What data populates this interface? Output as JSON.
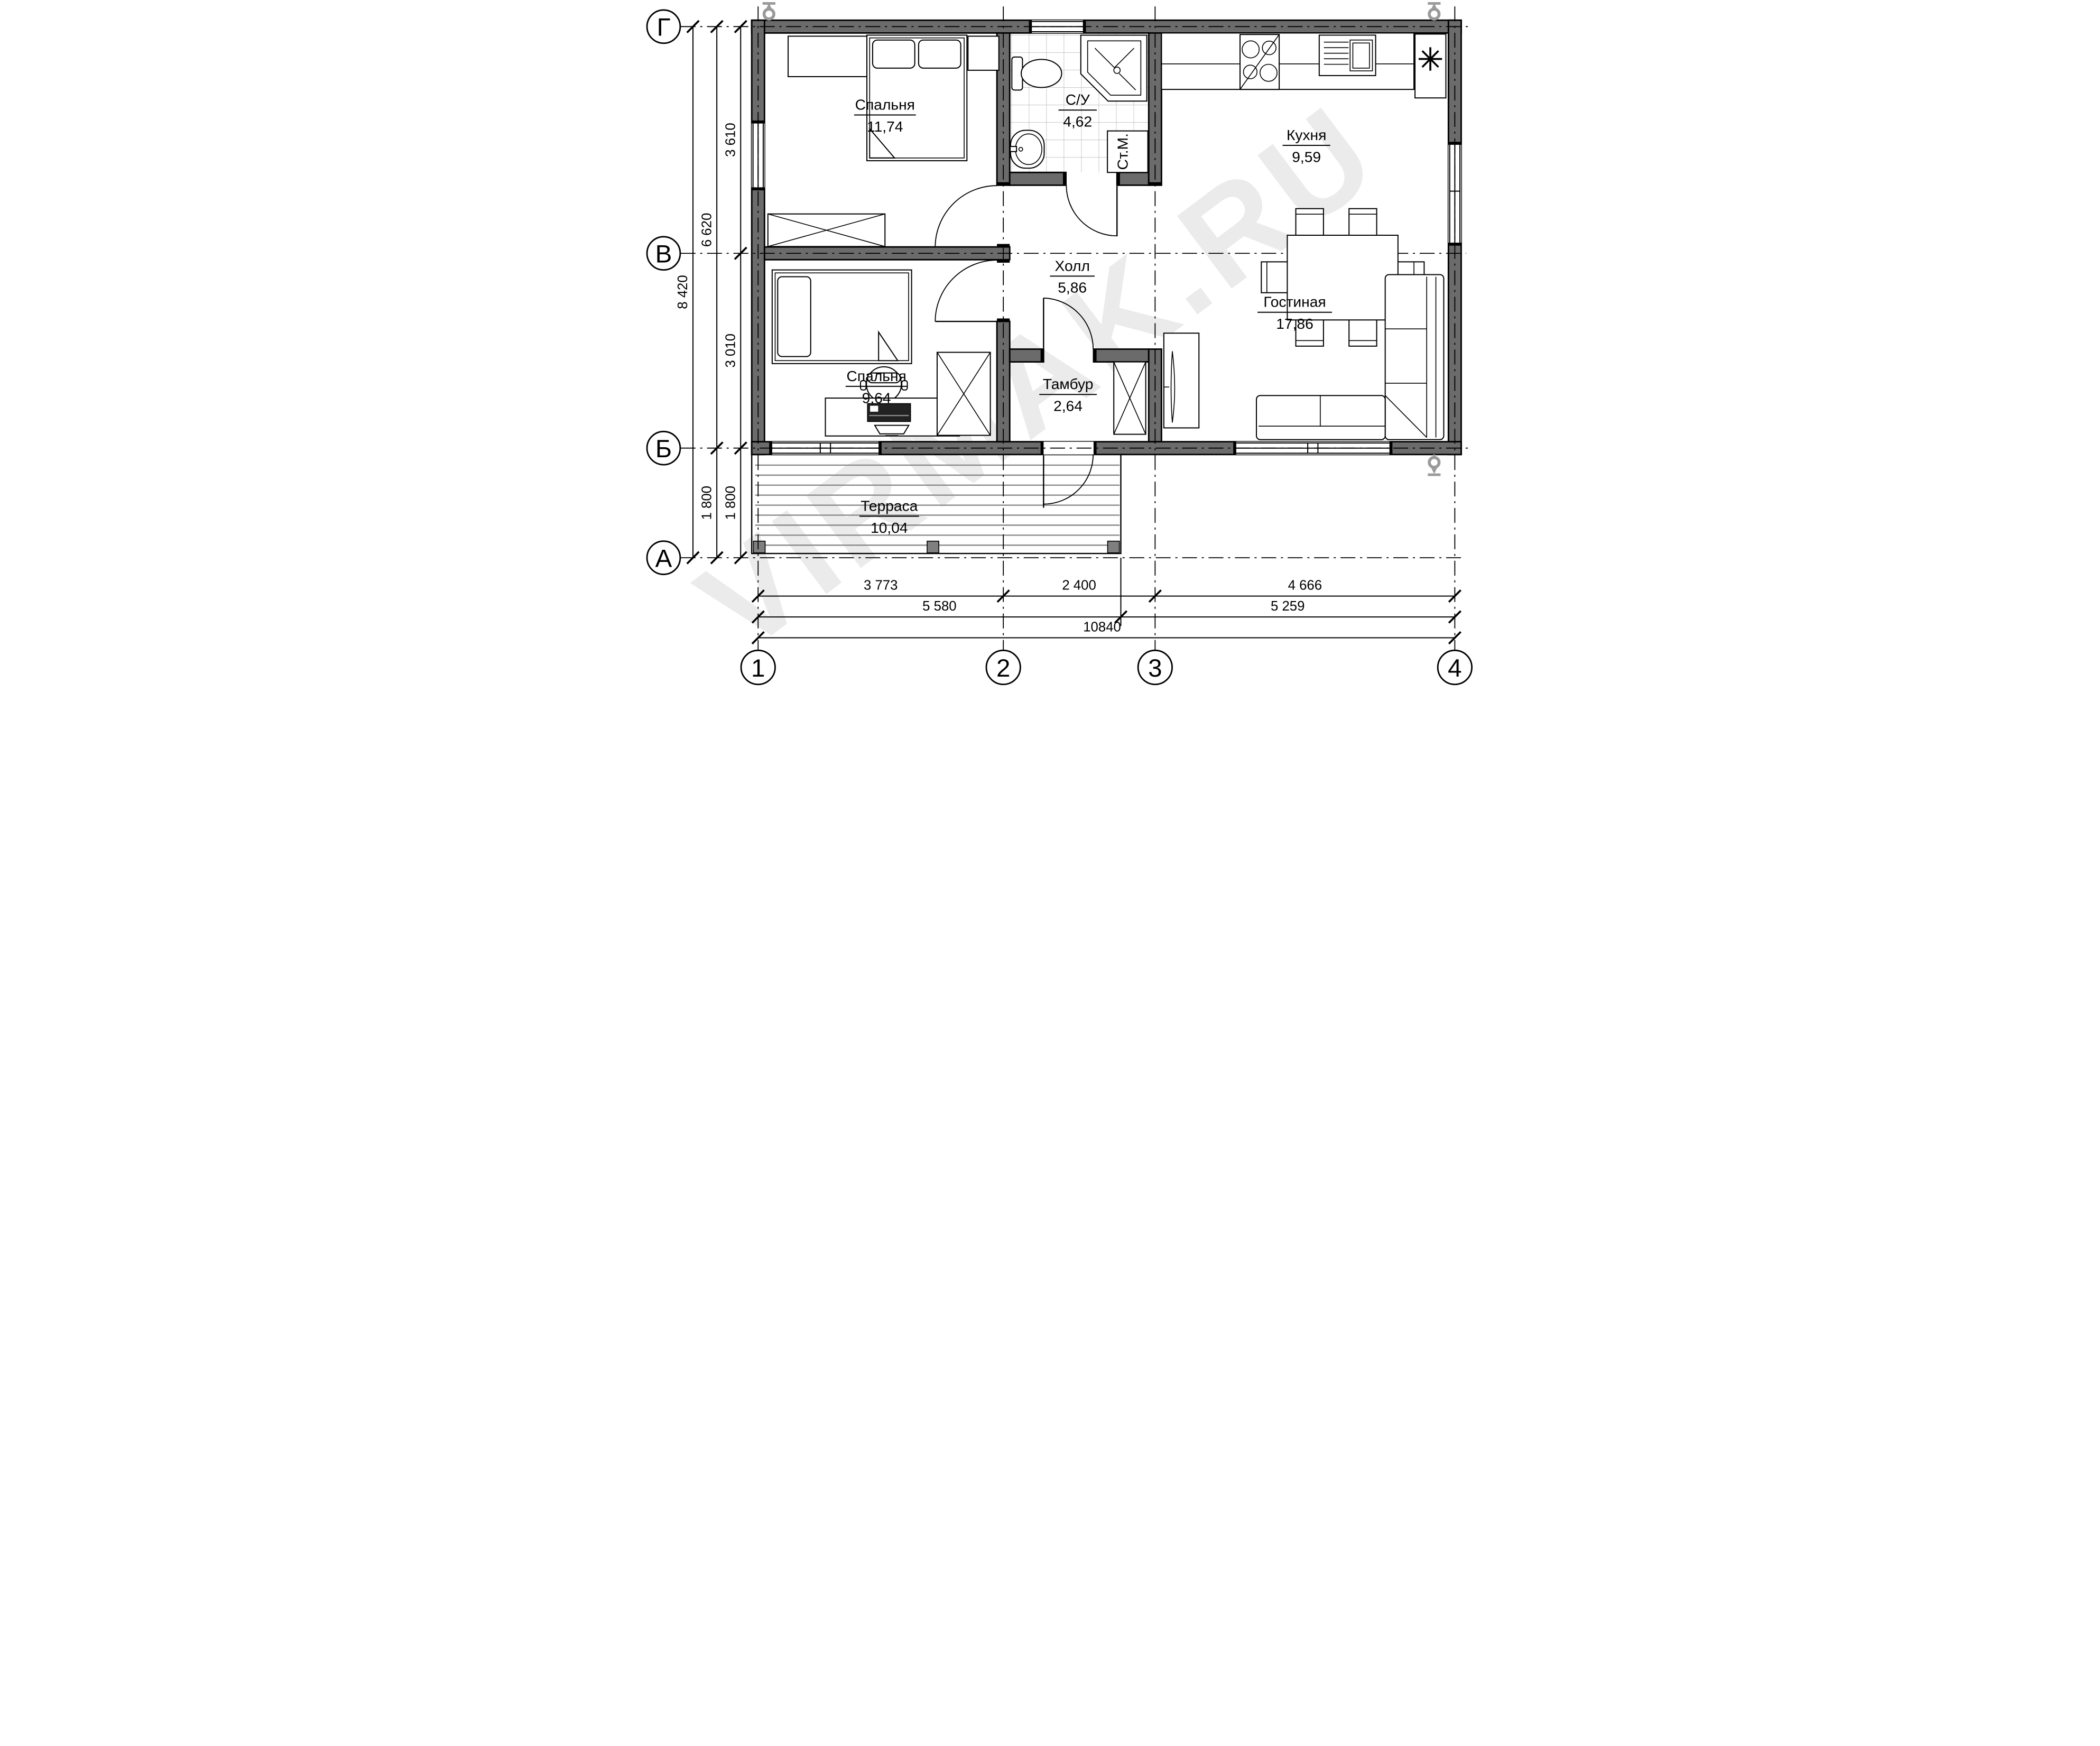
{
  "watermark": "VIRMAK.RU",
  "rooms": [
    {
      "name": "Спальня",
      "area": "11,74"
    },
    {
      "name": "С/У",
      "area": "4,62"
    },
    {
      "name": "Кухня",
      "area": "9,59"
    },
    {
      "name": "Холл",
      "area": "5,86"
    },
    {
      "name": "Спальня",
      "area": "9,64"
    },
    {
      "name": "Гостиная",
      "area": "17,86"
    },
    {
      "name": "Тамбур",
      "area": "2,64"
    },
    {
      "name": "Терраса",
      "area": "10,04"
    }
  ],
  "labels": {
    "washing_machine": "Ст.М.",
    "fridge_symbol": "✳"
  },
  "axes": {
    "rows": [
      "Г",
      "В",
      "Б",
      "А"
    ],
    "cols": [
      "1",
      "2",
      "3",
      "4"
    ]
  },
  "dimensions": {
    "left_inner": [
      "3 610",
      "3 010",
      "1 800"
    ],
    "left_middle": [
      "6 620",
      "1 800"
    ],
    "left_outer": [
      "8 420"
    ],
    "bottom_row1": [
      "3 773",
      "2 400",
      "4 666"
    ],
    "bottom_row2": [
      "5 580",
      "5 259"
    ],
    "bottom_row3": [
      "10840"
    ]
  },
  "colors": {
    "wall": "#6b6b6b",
    "watermark": "#ebebeb",
    "symbol_gray": "#9a9a9a"
  }
}
